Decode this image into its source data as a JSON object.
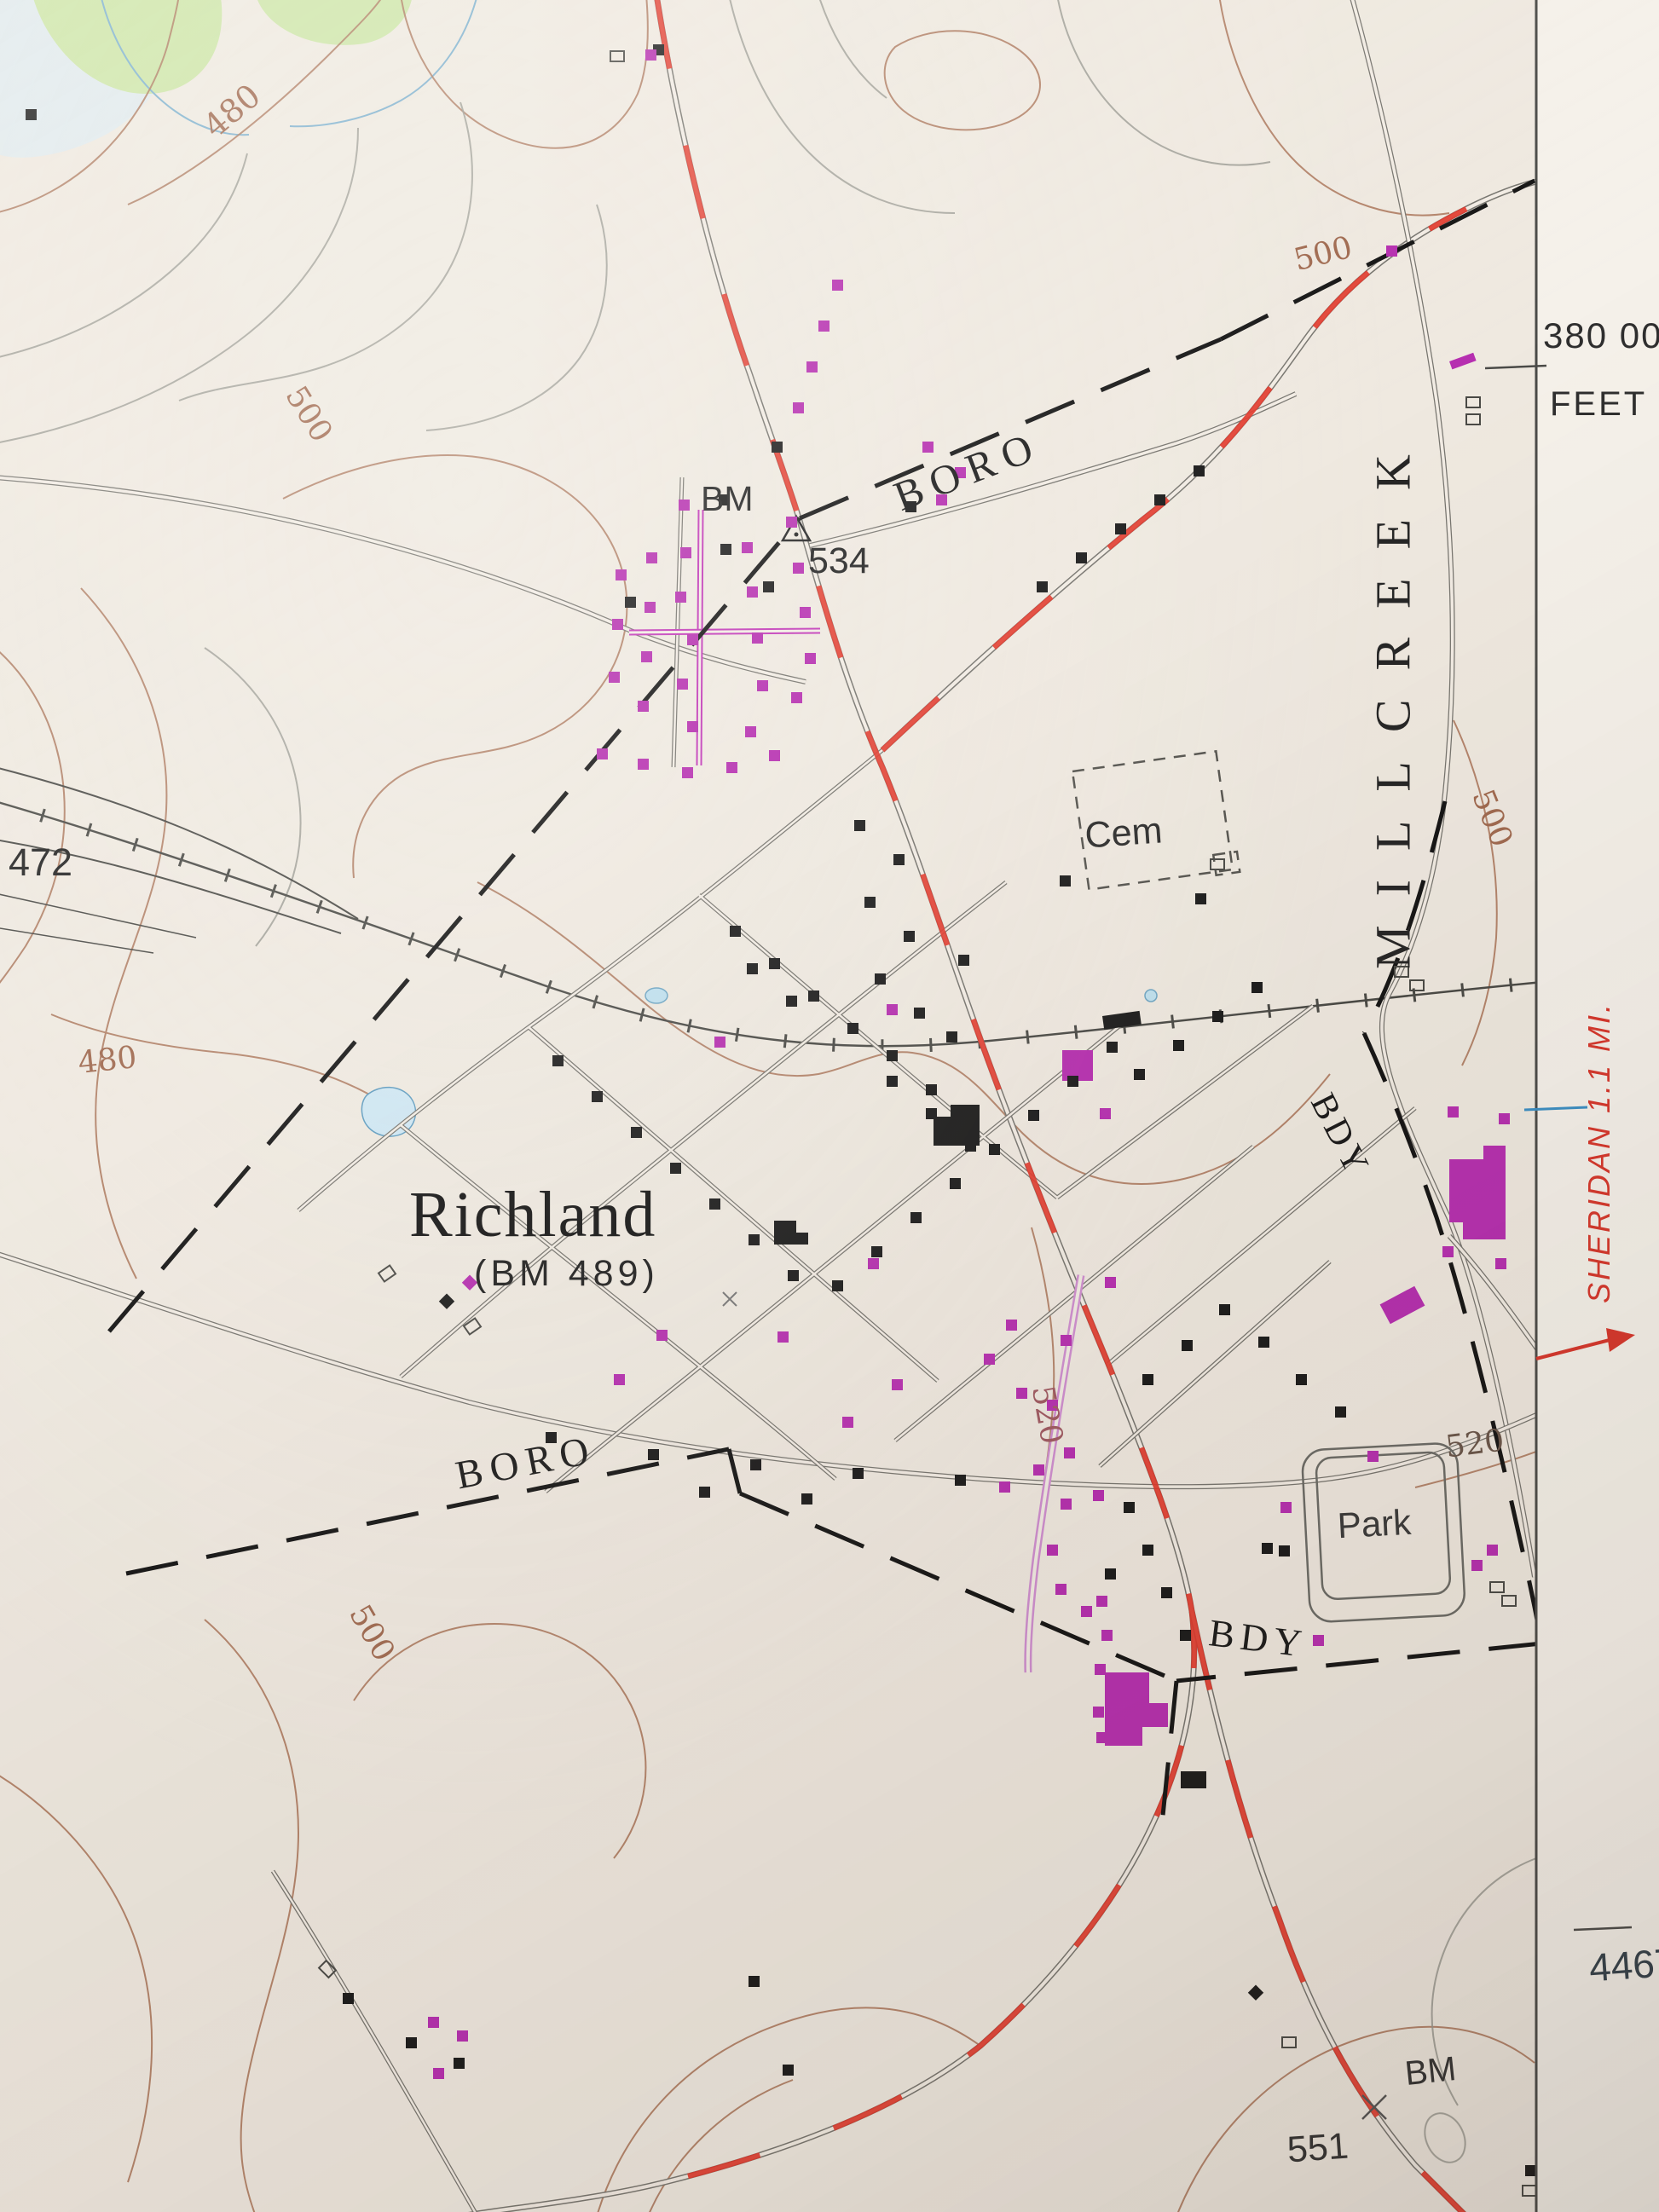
{
  "place_labels": {
    "town": "Richland",
    "town_benchmark": "(BM 489)",
    "township": "MILLCREEK",
    "cemetery": "Cem",
    "park": "Park"
  },
  "boundary_labels": {
    "boro_north": "BORO",
    "boro_southwest": "BORO",
    "bdy_east": "BDY",
    "bdy_south": "BDY"
  },
  "benchmarks": {
    "north_label": "BM",
    "north_elevation": "534",
    "southeast_label": "BM",
    "southeast_elevation": "551",
    "spot_elevation_west": "472"
  },
  "contour_labels": {
    "c480_nw": "480",
    "c480_w": "480",
    "c500_nw": "500",
    "c500_ne": "500",
    "c500_e": "500",
    "c500_sw": "500",
    "c520_center": "520",
    "c520_east": "520"
  },
  "margin": {
    "feet_value": "380 00",
    "feet_unit": "FEET",
    "northing": "4467",
    "destination_note": "SHERIDAN 1.1 MI."
  },
  "colors": {
    "paper": "#efe9e0",
    "collar": "#f5f1ea",
    "contour_brown": "#ad7a5f",
    "highway_red": "#e2382b",
    "building_black": "#1b1b1b",
    "building_purple": "#b62fb0",
    "new_road_pink": "#cf8fd0",
    "water_blue": "#bfe0ee",
    "woodland_green": "#cde6a8",
    "boundary_black": "#151515"
  }
}
